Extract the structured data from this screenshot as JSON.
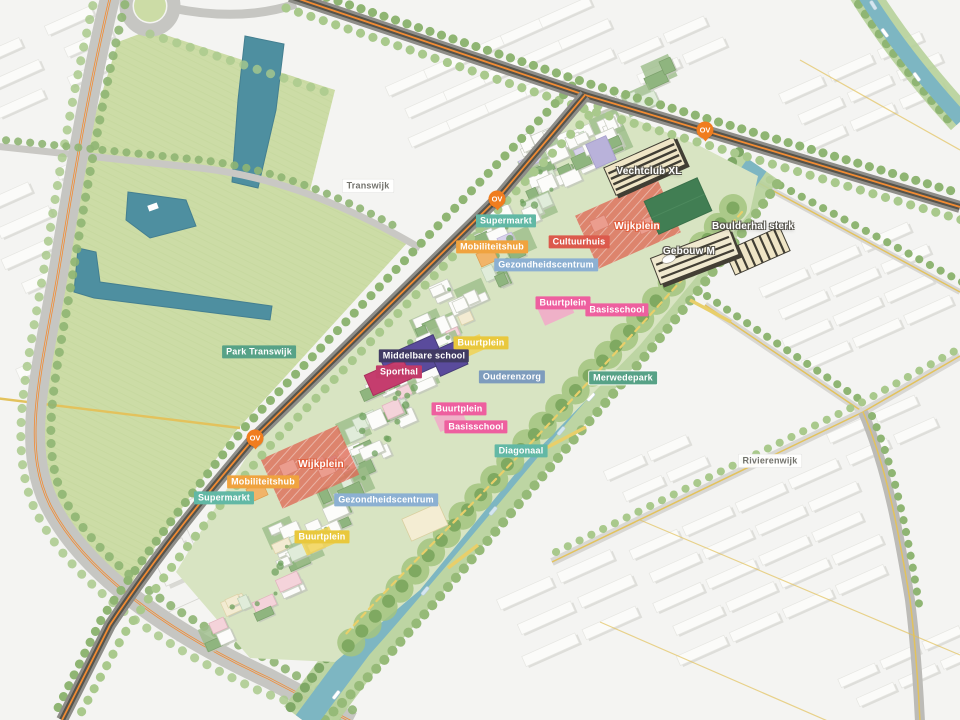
{
  "palette": {
    "teal": "#62b8a5",
    "orange": "#f0a33f",
    "red": "#dc5a4c",
    "blue": "#8cb0d2",
    "pink": "#ee5f9f",
    "yellow": "#e9c83d",
    "navy": "#403a63",
    "crimson": "#c23b69",
    "bluegray": "#7e9cbd",
    "green": "#57a287",
    "ov": "#f07d1f",
    "canal": "#7db6c2",
    "park": "#ccdca6",
    "site_green": "#d8e4c2",
    "road_dark": "#55534b",
    "route_orange": "#f18b33",
    "route_yellow": "#e3c25c",
    "plaza_red": "#df6b57"
  },
  "map_labels": [
    {
      "text": "Transwijk",
      "category": "district"
    },
    {
      "text": "Park Transwijk",
      "category": "park"
    },
    {
      "text": "Supermarkt",
      "category": "facility"
    },
    {
      "text": "Mobiliteitshub",
      "category": "facility"
    },
    {
      "text": "Cultuurhuis",
      "category": "facility"
    },
    {
      "text": "Wijkplein",
      "category": "plaza"
    },
    {
      "text": "Vechtclub XL",
      "category": "building"
    },
    {
      "text": "Boulderhal sterk",
      "category": "building"
    },
    {
      "text": "Gebouw M",
      "category": "building"
    },
    {
      "text": "Gezondheidscentrum",
      "category": "facility"
    },
    {
      "text": "Buurtplein",
      "category": "plaza"
    },
    {
      "text": "Basisschool",
      "category": "facility"
    },
    {
      "text": "Buurtplein",
      "category": "plaza"
    },
    {
      "text": "Middelbare school",
      "category": "facility"
    },
    {
      "text": "Sporthal",
      "category": "facility"
    },
    {
      "text": "Ouderenzorg",
      "category": "facility"
    },
    {
      "text": "Merwedepark",
      "category": "park"
    },
    {
      "text": "Buurtplein",
      "category": "plaza"
    },
    {
      "text": "Basisschool",
      "category": "facility"
    },
    {
      "text": "Diagonaal",
      "category": "path"
    },
    {
      "text": "Wijkplein",
      "category": "plaza"
    },
    {
      "text": "Mobiliteitshub",
      "category": "facility"
    },
    {
      "text": "Supermarkt",
      "category": "facility"
    },
    {
      "text": "Gezondheidscentrum",
      "category": "facility"
    },
    {
      "text": "Buurtplein",
      "category": "plaza"
    },
    {
      "text": "Rivierenwijk",
      "category": "district"
    }
  ],
  "ov_stop": {
    "label": "OV"
  }
}
